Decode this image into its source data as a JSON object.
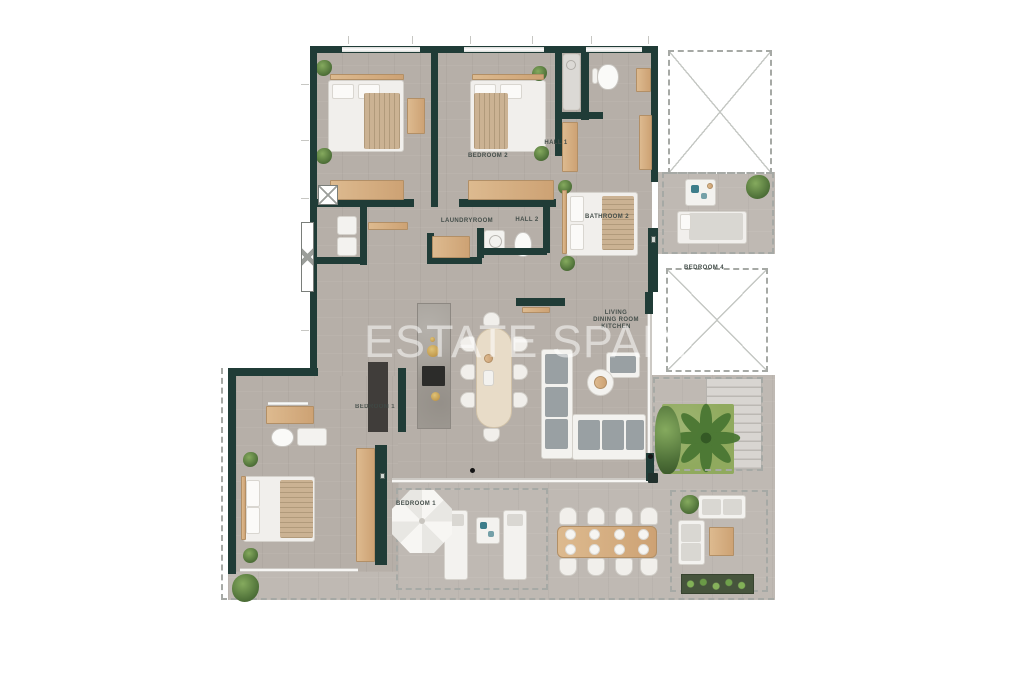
{
  "watermark": {
    "text": "ESTATE SPAIN"
  },
  "labels": {
    "bedroom2": "BEDROOM 2",
    "bathroom3": "BATHROOM 3",
    "hall1": "HALL 1",
    "laundryroom": "LAUNDRYROOM",
    "hall2": "HALL 2",
    "bathroom2": "BATHROOM 2",
    "bedroom4": "BEDROOM 4",
    "living_line1": "LIVING",
    "living_line2": "DINING ROOM",
    "living_line3": "KITCHEN",
    "bedroom1_wardrobe": "BEDROOM 1",
    "bedroom1_terrace": "BEDROOM 1"
  },
  "colors": {
    "wall": "#203c37",
    "floor": "#b6afa8",
    "terrace_floor": "#bfb9b3",
    "wood": "#d7b288",
    "white_furniture": "#f3f2ef",
    "greenery": "#4e7038",
    "dashed_outline": "#a6a9a5",
    "label_text": "#454f4b",
    "teal_accent": "#3d7d8a",
    "watermark": "rgba(255,255,255,0.52)"
  }
}
